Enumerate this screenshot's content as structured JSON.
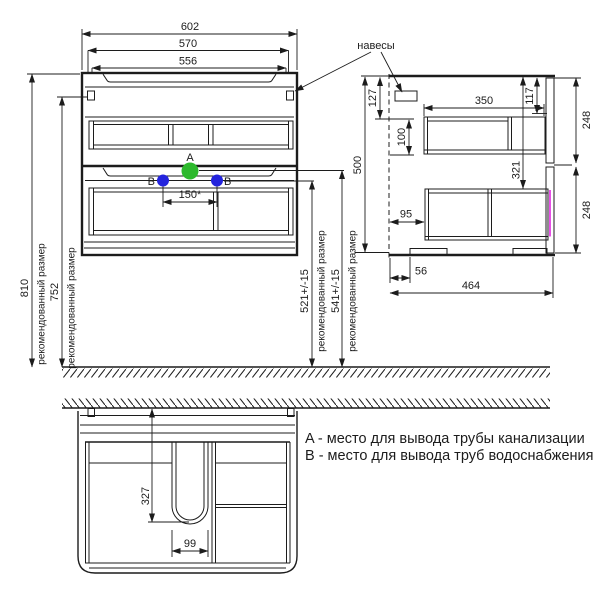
{
  "legend": {
    "line_a": "A - место для вывода трубы канализации",
    "line_b": "B - место для вывода труб водоснабжения"
  },
  "labels": {
    "hangers": "навесы",
    "recommended_size": "рекомендованный размер",
    "marker_a": "A",
    "marker_b": "B"
  },
  "front_view": {
    "width_overall": "602",
    "width_inner": "570",
    "width_basin": "556",
    "height_recommended": "810",
    "height_hangers": "752",
    "water_outlets_spacing": "150*",
    "drain_outlet_height": "541+/-15",
    "water_outlet_height": "521+/-15"
  },
  "side_view": {
    "cabinet_height": "500",
    "hanger_top_offset": "127",
    "hanger_drop": "100",
    "drawer_depth": "350",
    "top_front_offset": "117",
    "upper_front_height": "248",
    "lower_front_height": "248",
    "lower_drawer_top_offset": "321",
    "wall_gap": "95",
    "leg_back_offset": "56",
    "overall_depth": "464"
  },
  "bottom_view": {
    "cutout_depth": "327",
    "cutout_width": "99"
  },
  "colors": {
    "marker_a": "#2db92d",
    "marker_b": "#2424dd",
    "line": "#1c1c1c",
    "magenta_edge": "#e332e3"
  }
}
